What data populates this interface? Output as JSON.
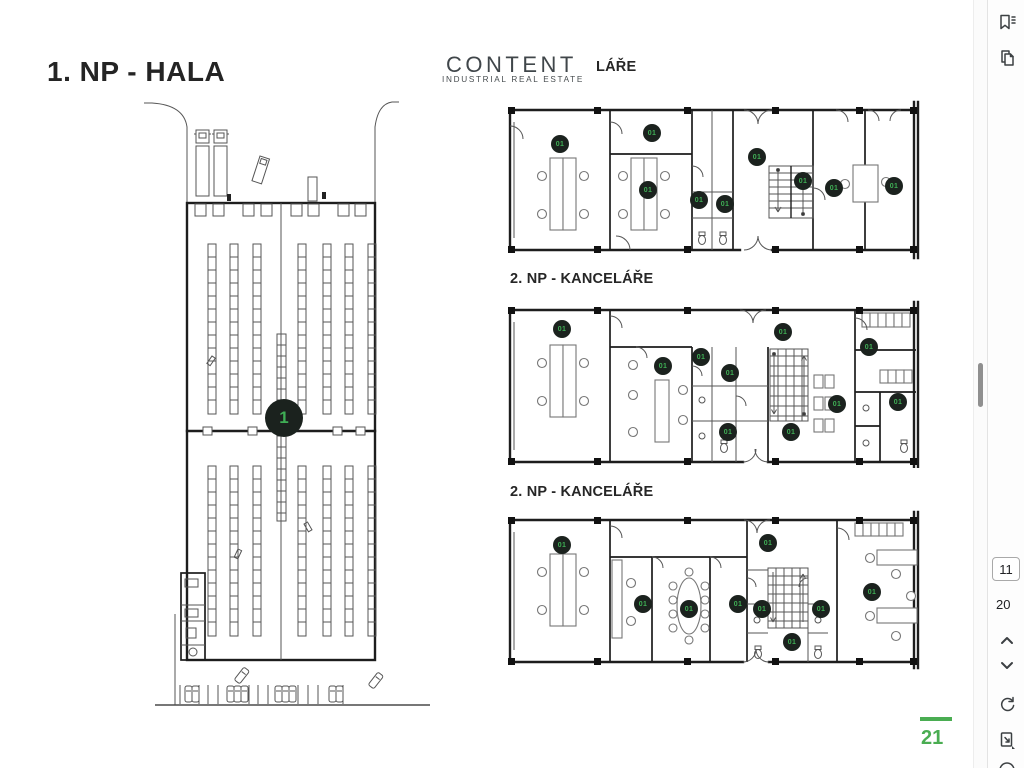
{
  "document": {
    "hala_title": "1. NP - HALA",
    "kancelare_title_top": "1. NP - KANCELÁŘE",
    "section_title_2": "2. NP - KANCELÁŘE",
    "section_title_3": "2. NP - KANCELÁŘE",
    "page_number": "21"
  },
  "logo": {
    "brand": "CONTENT",
    "tagline": "INDUSTRIAL REAL ESTATE",
    "dark_color": "#41474b",
    "yellow_color": "#c6d22e"
  },
  "colors": {
    "accent_green": "#4aad52",
    "badge_background": "#1b221e",
    "badge_text": "#3fae55"
  },
  "plans": {
    "hall": {
      "label": "1",
      "badges": [
        {
          "x": 176,
          "y": 324
        }
      ]
    },
    "planA": {
      "label": "01",
      "badges": [
        {
          "x": 54,
          "y": 48
        },
        {
          "x": 146,
          "y": 37
        },
        {
          "x": 142,
          "y": 94
        },
        {
          "x": 193,
          "y": 104
        },
        {
          "x": 219,
          "y": 108
        },
        {
          "x": 251,
          "y": 61
        },
        {
          "x": 297,
          "y": 85
        },
        {
          "x": 328,
          "y": 92
        },
        {
          "x": 388,
          "y": 90
        }
      ]
    },
    "planB": {
      "label": "01",
      "badges": [
        {
          "x": 56,
          "y": 33
        },
        {
          "x": 157,
          "y": 70
        },
        {
          "x": 195,
          "y": 61
        },
        {
          "x": 224,
          "y": 77
        },
        {
          "x": 277,
          "y": 36
        },
        {
          "x": 331,
          "y": 108
        },
        {
          "x": 222,
          "y": 136
        },
        {
          "x": 285,
          "y": 136
        },
        {
          "x": 363,
          "y": 51
        },
        {
          "x": 392,
          "y": 106
        }
      ]
    },
    "planC": {
      "label": "01",
      "badges": [
        {
          "x": 56,
          "y": 37
        },
        {
          "x": 137,
          "y": 96
        },
        {
          "x": 183,
          "y": 101
        },
        {
          "x": 232,
          "y": 96
        },
        {
          "x": 262,
          "y": 35
        },
        {
          "x": 256,
          "y": 101
        },
        {
          "x": 315,
          "y": 101
        },
        {
          "x": 286,
          "y": 134
        },
        {
          "x": 366,
          "y": 84
        }
      ]
    }
  },
  "viewer": {
    "current_page": "11",
    "total_pages": "20",
    "icons": [
      "bookmarks-icon",
      "pages-icon",
      "page-up-icon",
      "page-down-icon",
      "refresh-icon",
      "export-page-icon",
      "more-icon"
    ]
  }
}
